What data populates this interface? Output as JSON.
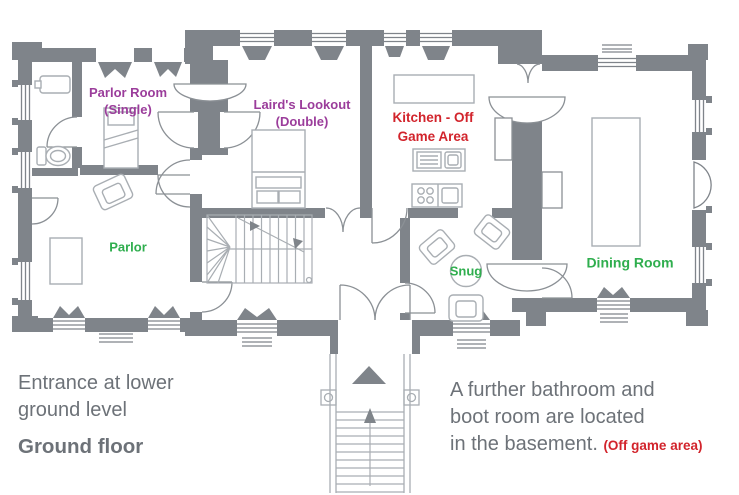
{
  "plan": {
    "rooms": {
      "parlor_room": {
        "line1": "Parlor Room",
        "line2": "(Single)"
      },
      "lairds_lookout": {
        "line1": "Laird's Lookout",
        "line2": "(Double)"
      },
      "kitchen": {
        "line1": "Kitchen - Off",
        "line2": "Game Area"
      },
      "parlor": {
        "label": "Parlor"
      },
      "snug": {
        "label": "Snug"
      },
      "dining_room": {
        "label": "Dining Room"
      }
    },
    "notes": {
      "entrance_line1": "Entrance at lower",
      "entrance_line2": "ground level",
      "floor_title": "Ground floor",
      "basement_line1": "A further bathroom and",
      "basement_line2": "boot room are located",
      "basement_line3": "in the basement.",
      "basement_offgame": "(Off game area)"
    },
    "colors": {
      "wall": "#7f848a",
      "furniture_line": "#a9aeb3",
      "bedroom_label": "#9b3d9b",
      "off_game_label": "#d2242c",
      "game_room_label": "#2fae4e",
      "note_text": "#6d7278"
    }
  }
}
